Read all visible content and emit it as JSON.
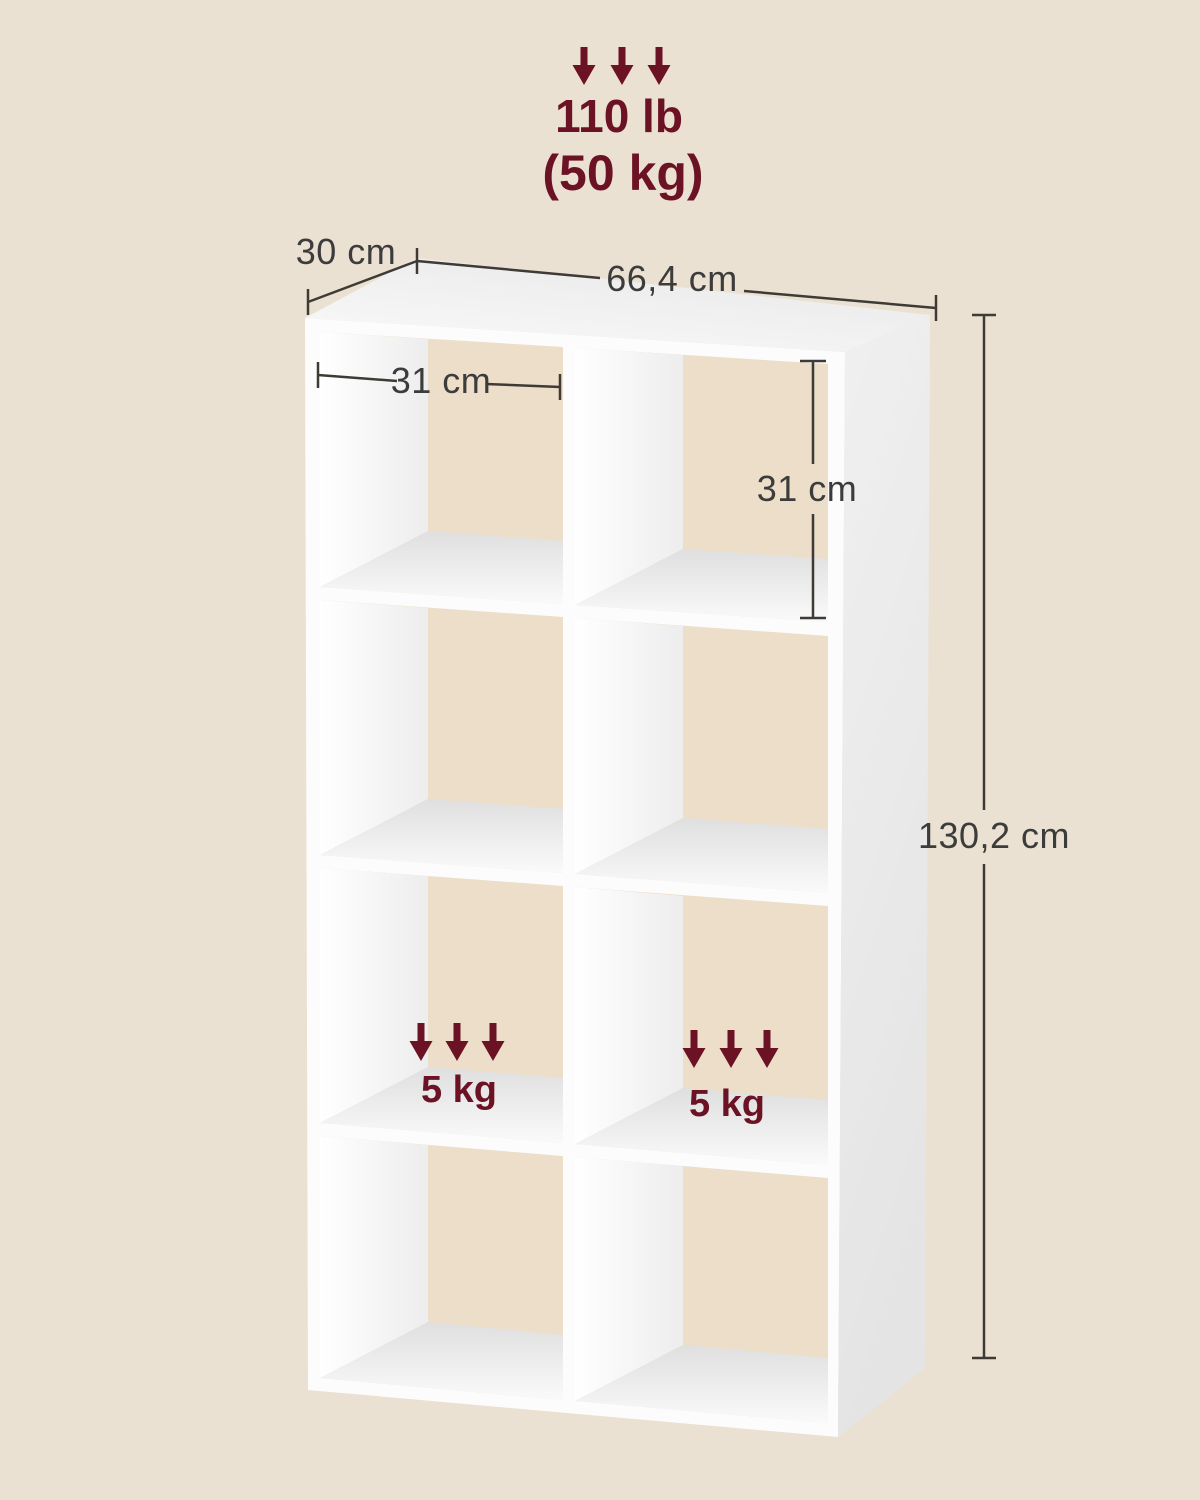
{
  "diagram": {
    "product": "8-cube open bookshelf",
    "structure": {
      "columns": 2,
      "rows": 4,
      "cubes": 8
    },
    "max_load": {
      "lb": "110 lb",
      "kg": "(50 kg)"
    },
    "dimensions": {
      "depth": "30 cm",
      "width": "66,4 cm",
      "inner_width": "31 cm",
      "inner_height": "31 cm",
      "height": "130,2 cm"
    },
    "shelf_loads": {
      "left": "5 kg",
      "right": "5 kg"
    },
    "colors": {
      "background": "#EBE1D2",
      "cube_back_beige": "#ECDEC9",
      "shelf_white": "#FCFCFC",
      "accent_maroon": "#6C1225",
      "dimension_line": "#3E3A36",
      "dimension_text": "#3C3C3C"
    },
    "icons": [
      "down-arrow-icon"
    ]
  }
}
